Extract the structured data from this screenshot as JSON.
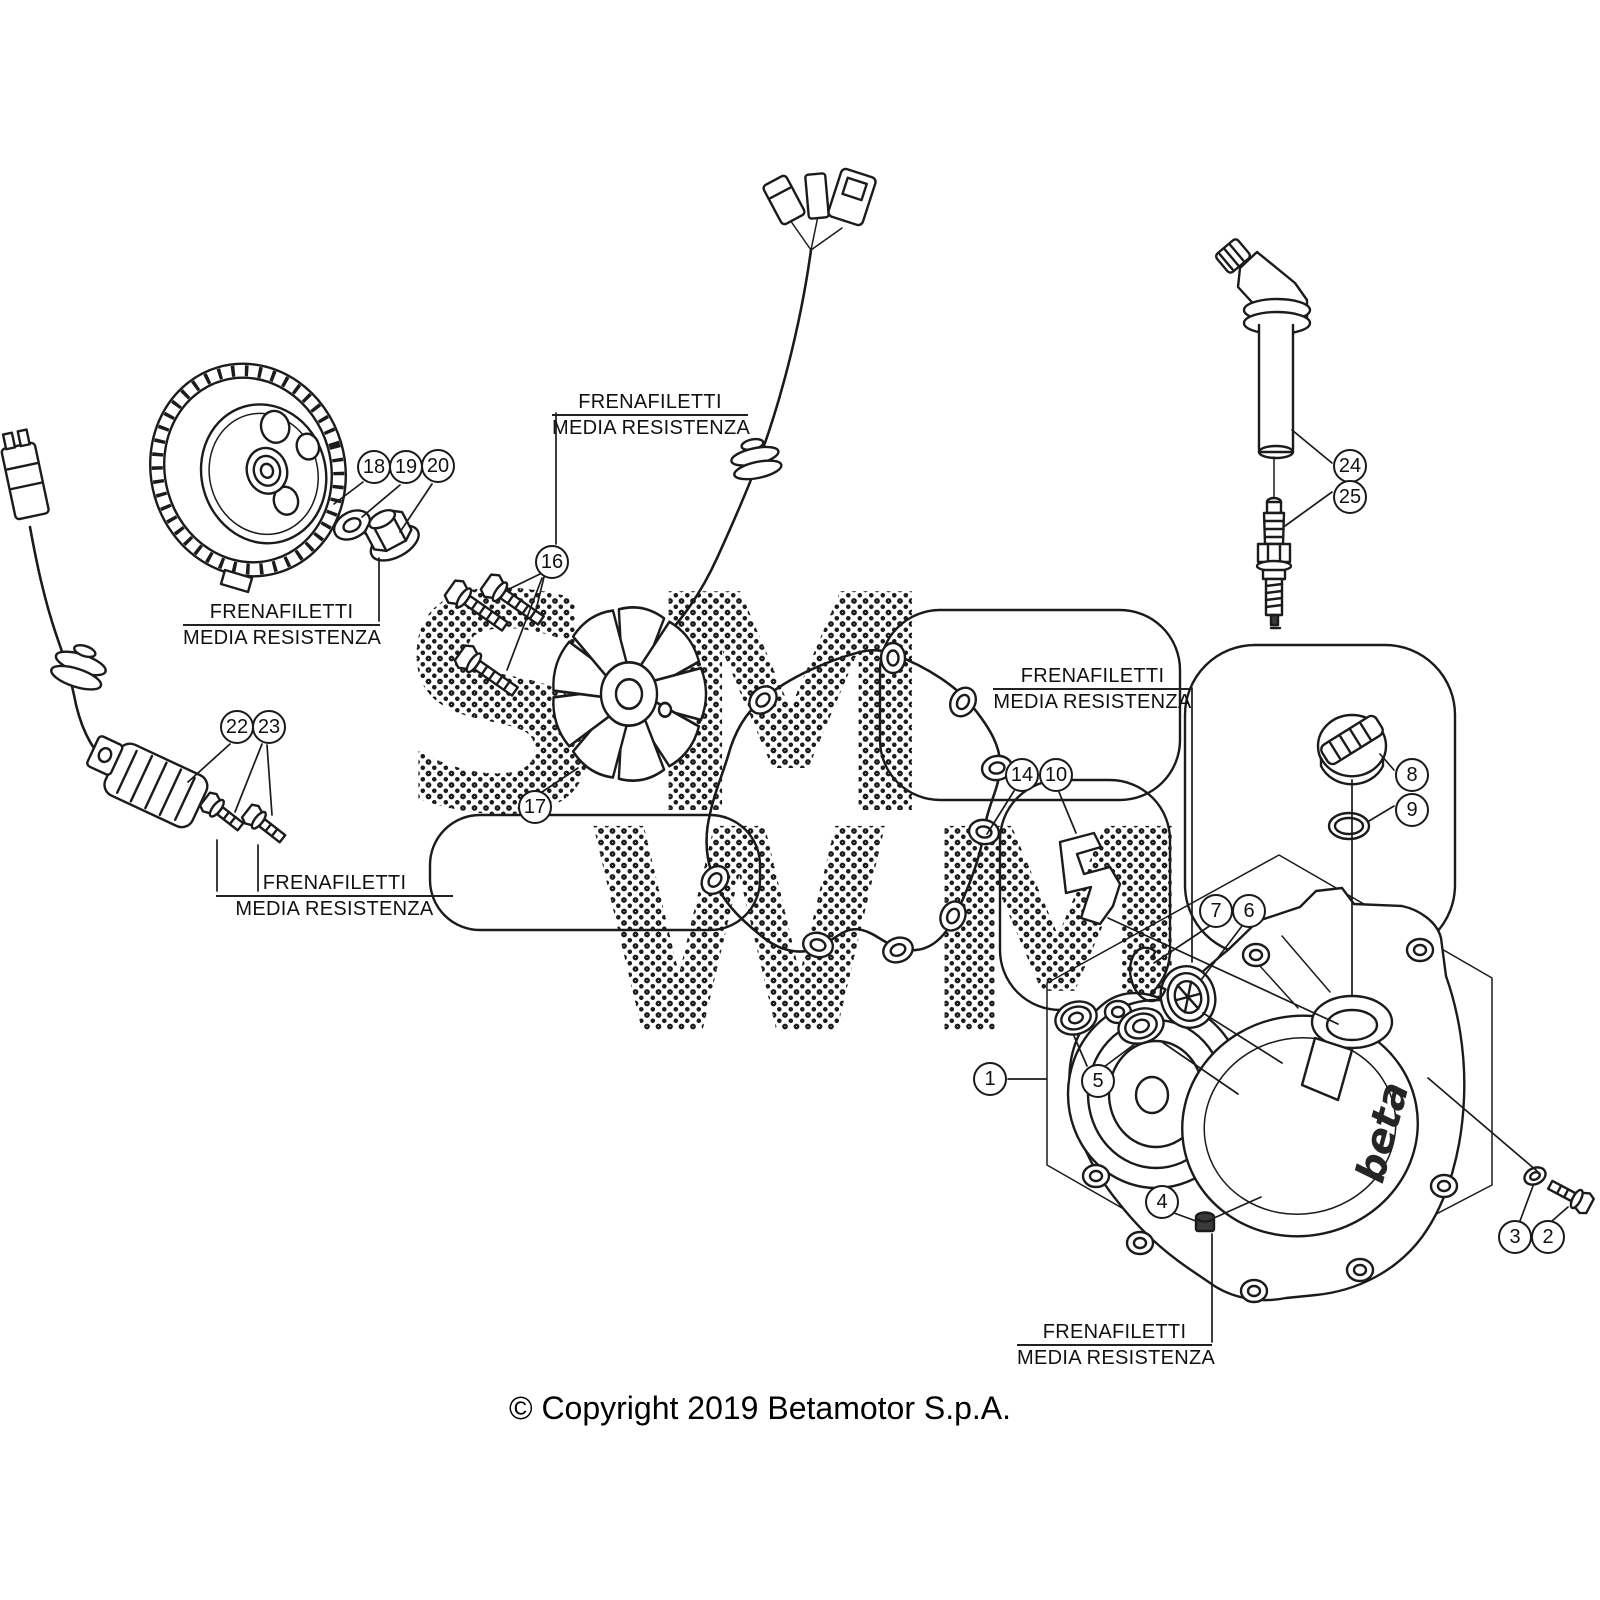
{
  "diagram": {
    "copyright": "© Copyright 2019 Betamotor S.p.A.",
    "note_line1": "FRENAFILETTI",
    "note_line2": "MEDIA RESISTENZA",
    "cover_logo": "beta",
    "watermark_top": "SM",
    "watermark_bottom": "WM",
    "callouts": [
      {
        "n": "1",
        "x": 990,
        "y": 1079
      },
      {
        "n": "2",
        "x": 1548,
        "y": 1237
      },
      {
        "n": "3",
        "x": 1515,
        "y": 1237
      },
      {
        "n": "4",
        "x": 1162,
        "y": 1202
      },
      {
        "n": "5",
        "x": 1098,
        "y": 1081
      },
      {
        "n": "6",
        "x": 1249,
        "y": 911
      },
      {
        "n": "7",
        "x": 1216,
        "y": 911
      },
      {
        "n": "8",
        "x": 1412,
        "y": 775
      },
      {
        "n": "9",
        "x": 1412,
        "y": 810
      },
      {
        "n": "10",
        "x": 1056,
        "y": 775
      },
      {
        "n": "14",
        "x": 1022,
        "y": 775
      },
      {
        "n": "16",
        "x": 552,
        "y": 562
      },
      {
        "n": "17",
        "x": 535,
        "y": 807
      },
      {
        "n": "18",
        "x": 374,
        "y": 467
      },
      {
        "n": "19",
        "x": 406,
        "y": 467
      },
      {
        "n": "20",
        "x": 438,
        "y": 466
      },
      {
        "n": "22",
        "x": 237,
        "y": 727
      },
      {
        "n": "23",
        "x": 269,
        "y": 727
      },
      {
        "n": "24",
        "x": 1350,
        "y": 466
      },
      {
        "n": "25",
        "x": 1350,
        "y": 497
      }
    ]
  }
}
